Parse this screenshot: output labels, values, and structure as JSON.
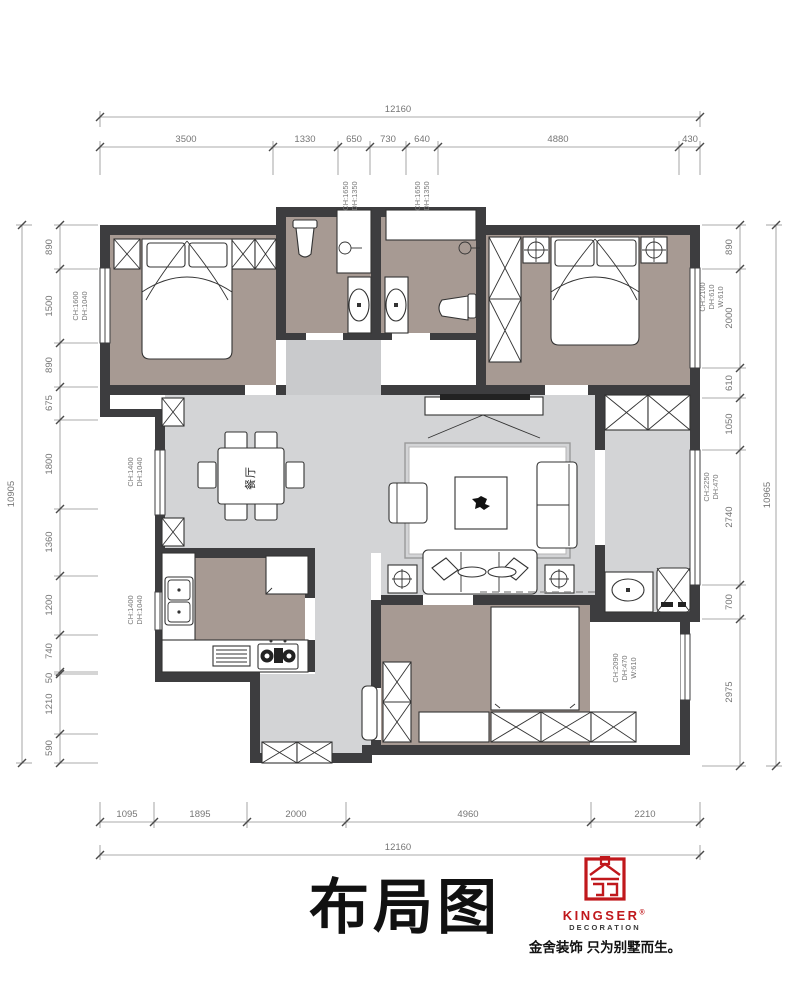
{
  "header": {
    "title": "布局图"
  },
  "logo": {
    "brand": "KINGSER",
    "reg": "®",
    "subtitle": "DECORATION",
    "tagline": "金舍装饰 只为别墅而生。"
  },
  "rooms": {
    "dining_label": "餐厅"
  },
  "dimensions": {
    "top": {
      "total": "12160",
      "segments": [
        "3500",
        "1330",
        "650",
        "730",
        "640",
        "4880",
        "430"
      ]
    },
    "bottom": {
      "total": "12160",
      "segments": [
        "1095",
        "1895",
        "2000",
        "4960",
        "2210"
      ]
    },
    "left": {
      "total": "10905",
      "segments": [
        "890",
        "1500",
        "890",
        "675",
        "1800",
        "1360",
        "1200",
        "740",
        "50",
        "1210",
        "590"
      ]
    },
    "right": {
      "total": "10965",
      "segments": [
        "890",
        "2000",
        "610",
        "1050",
        "2740",
        "700",
        "2975"
      ]
    }
  },
  "window_labels": {
    "bath_a": [
      "CH:1650",
      "DH:1350"
    ],
    "bath_b": [
      "CH:1650",
      "DH:1350"
    ],
    "bedroom1": [
      "CH:1600",
      "DH:1040"
    ],
    "bedroom2": [
      "CH:2100",
      "DH:610",
      "W:610"
    ],
    "dining": [
      "CH:1400",
      "DH:1040"
    ],
    "kitchen": [
      "CH:1400",
      "DH:1040"
    ],
    "balcony": [
      "CH:2250",
      "DH:470"
    ],
    "bedroom3": [
      "CH:2090",
      "DH:470",
      "W:610"
    ]
  }
}
